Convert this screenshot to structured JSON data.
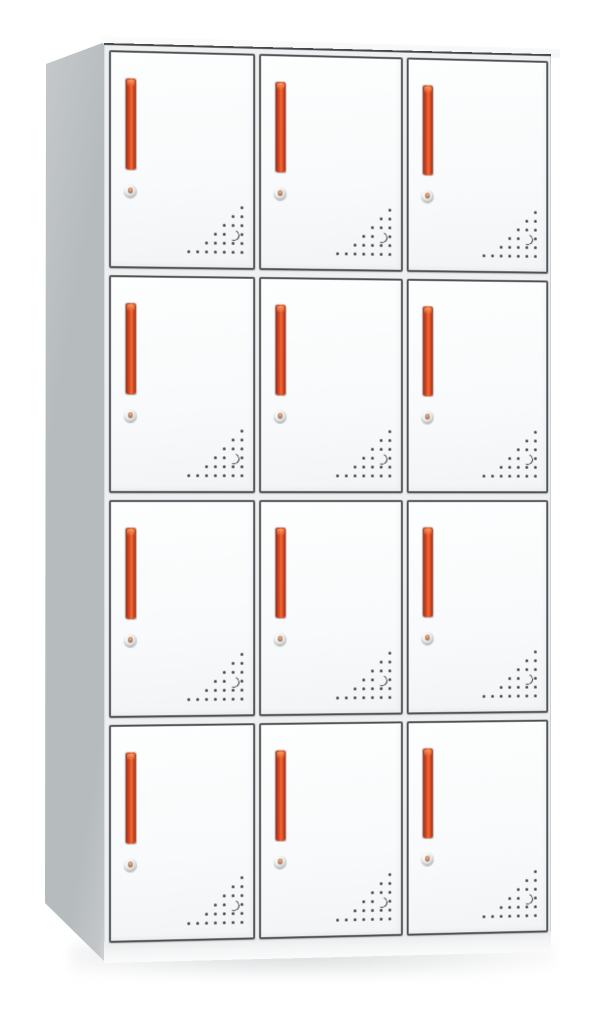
{
  "scene": {
    "description": "Product photograph of a white steel locker cabinet with twelve compartments arranged in four rows and three columns. Each door has a recessed vertical red handle, a round cam lock below the handle, and a triangular cluster of ventilation perforations in its lower-right corner. The cabinet is viewed slightly from the left so its gray left side panel is visible; plain white background.",
    "background": "#ffffff"
  },
  "cabinet": {
    "rows": 4,
    "columns": 3,
    "door_count": 12,
    "parts": {
      "door": "locker door",
      "handle": "vertical red recessed handle",
      "lock": "round cam lock with keyhole",
      "vent": "perforated corner vent"
    }
  },
  "layout": {
    "front": {
      "left": 104,
      "top": 43,
      "width": 460,
      "height": 918,
      "rotate_deg": 5
    },
    "grid": {
      "origin_x": 5,
      "origin_y": 5,
      "door_w": 144,
      "door_h": 214,
      "gap_x": 8,
      "gap_y": 11
    },
    "handle": {
      "left": 15,
      "top": 26,
      "width": 10,
      "height": 91
    },
    "lock": {
      "left": 13,
      "top": 132,
      "size": 13
    },
    "vent": {
      "right": 9,
      "bottom": 13,
      "pitch": 9,
      "dot": 3
    }
  },
  "vent_pattern": {
    "rows": [
      {
        "dots": [
          6
        ]
      },
      {
        "dots": [
          5,
          6
        ]
      },
      {
        "dots": [
          4,
          5,
          6
        ]
      },
      {
        "dots": [
          3,
          4,
          6
        ],
        "crescent": 5
      },
      {
        "dots": [
          2,
          3,
          4,
          5,
          6
        ]
      },
      {
        "dots": [
          0,
          1,
          2,
          3,
          4,
          5,
          6
        ]
      }
    ]
  },
  "colors": {
    "bg": "#ffffff",
    "handle_red": "#e05228",
    "handle_dark": "#96301c",
    "handle_bright": "#f06c31",
    "door_outline": "#4e5255",
    "frame": "#eef0f1",
    "side_gray": "#b6bbbe",
    "side_light": "#c6cacc",
    "top_face": "#f4f5f6",
    "vent_dot": "#42464a"
  }
}
